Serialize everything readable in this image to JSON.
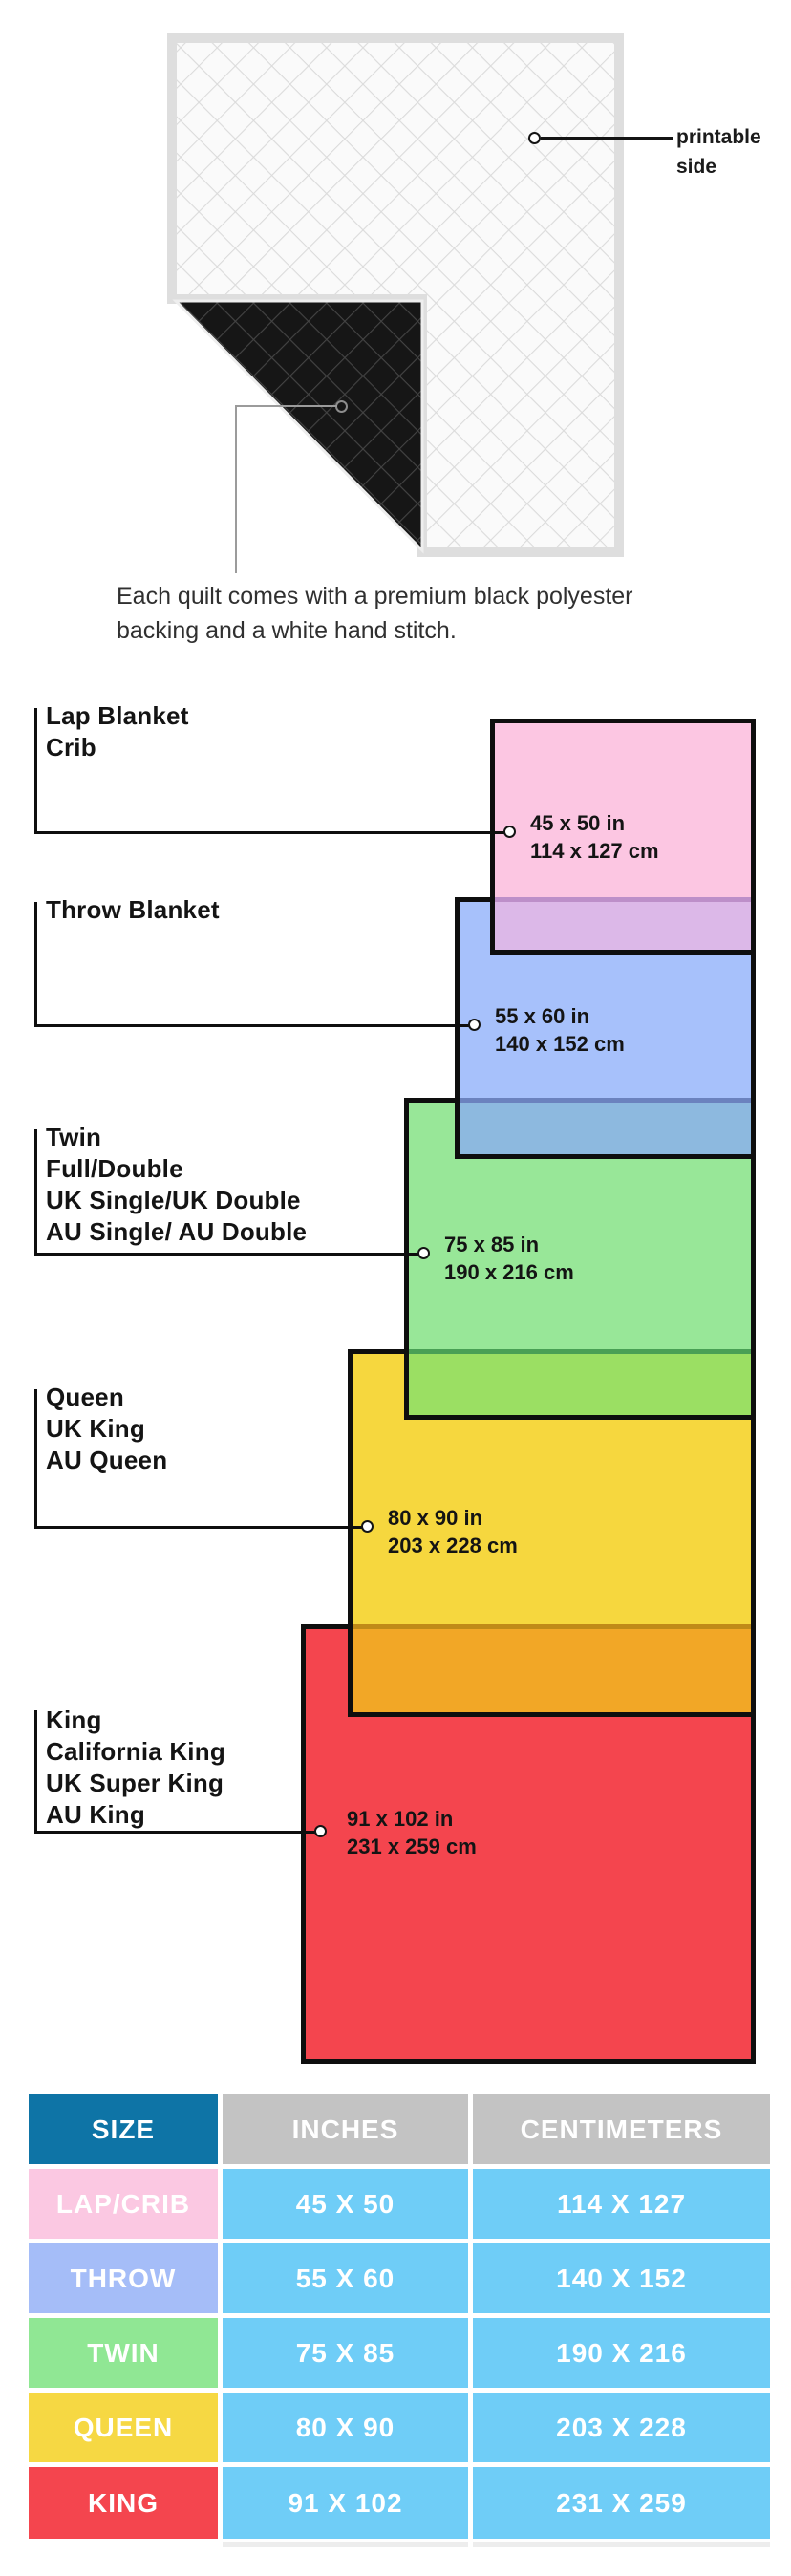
{
  "chart_data": {
    "type": "table",
    "title": "Quilt blanket size chart",
    "columns": [
      "SIZE",
      "INCHES",
      "CENTIMETERS"
    ],
    "categories": [
      "LAP/CRIB",
      "THROW",
      "TWIN",
      "QUEEN",
      "KING"
    ],
    "inches": [
      "45 X 50",
      "55 X 60",
      "75 X 85",
      "80 X 90",
      "91 X 102"
    ],
    "centimeters": [
      "114 X 127",
      "140 X 152",
      "190 X 216",
      "203 X 228",
      "231 X 259"
    ],
    "legend_position": "none",
    "grid": false
  },
  "quilt": {
    "printable_line1": "printable",
    "printable_line2": "side",
    "caption_line1": "Each quilt comes with a premium black polyester",
    "caption_line2": "backing and a white hand stitch."
  },
  "diagram": {
    "groups": [
      {
        "lines": [
          "Lap Blanket",
          "Crib"
        ],
        "size_in": "45 x 50 in",
        "size_cm": "114 x 127 cm",
        "fill": "#fcc6e2"
      },
      {
        "lines": [
          "Throw Blanket"
        ],
        "size_in": "55 x 60 in",
        "size_cm": "140 x 152 cm",
        "fill": "#a7c1fb"
      },
      {
        "lines": [
          "Twin",
          "Full/Double",
          "UK Single/UK Double",
          "AU Single/ AU Double"
        ],
        "size_in": "75 x 85 in",
        "size_cm": "190 x 216 cm",
        "fill": "#98e798"
      },
      {
        "lines": [
          "Queen",
          "UK King",
          "AU Queen"
        ],
        "size_in": "80 x 90 in",
        "size_cm": "203 x 228 cm",
        "fill": "#f6d73e"
      },
      {
        "lines": [
          "King",
          "California King",
          "UK Super King",
          "AU King"
        ],
        "size_in": "91 x 102 in",
        "size_cm": "231 x 259 cm",
        "fill": "#f4454e"
      }
    ],
    "overlaps": {
      "pink_blue": "#dcb8e8",
      "blue_green": "#8db9df",
      "green_yellow": "#9bdf63",
      "yellow_red": "#f2a726"
    },
    "outline": "#0e0e0e"
  },
  "table": {
    "headers": [
      "SIZE",
      "INCHES",
      "CENTIMETERS"
    ],
    "rows": [
      {
        "size": "LAP/CRIB",
        "inches": "45 X 50",
        "cm": "114 X 127",
        "color": "#fbc8e2"
      },
      {
        "size": "THROW",
        "inches": "55 X 60",
        "cm": "140 X 152",
        "color": "#a5bdf8"
      },
      {
        "size": "TWIN",
        "inches": "75 X 85",
        "cm": "190 X 216",
        "color": "#90e794"
      },
      {
        "size": "QUEEN",
        "inches": "80 X 90",
        "cm": "203 X 228",
        "color": "#f6d843"
      },
      {
        "size": "KING",
        "inches": "91 X 102",
        "cm": "231 X 259",
        "color": "#f4454e"
      }
    ],
    "header_blue": "#0e74a6",
    "header_gray": "#c3c3c3",
    "value_cell_blue": "#6fcdf7"
  }
}
